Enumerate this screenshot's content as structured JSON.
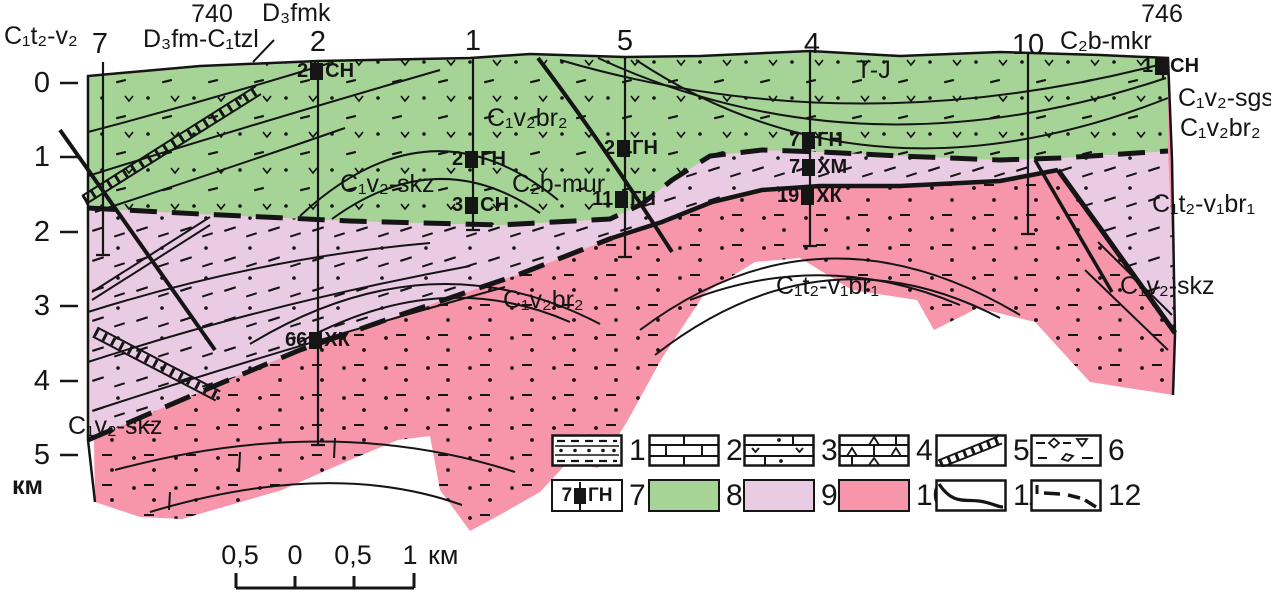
{
  "colors": {
    "green": "#a6d497",
    "lilac": "#eacbe4",
    "pink": "#f796ab",
    "line": "#151515"
  },
  "depth_axis": {
    "ticks": [
      "0",
      "1",
      "2",
      "3",
      "4",
      "5"
    ],
    "unit": "км"
  },
  "top_labels": {
    "left_strat": "C₁t₂-v₂",
    "elev_left": "740",
    "dfm_tzl": "D₃fm-C₁tzl",
    "dfmk": "D₃fmk",
    "elev_right": "746",
    "cb_mkr": "C₂b-mkr"
  },
  "wells": [
    {
      "number": "7"
    },
    {
      "number": "2"
    },
    {
      "number": "1"
    },
    {
      "number": "5"
    },
    {
      "number": "4"
    },
    {
      "number": "10"
    }
  ],
  "zone_labels": {
    "tj": "T-J",
    "green_br2": "C₁v₂br₂",
    "green_skz": "C₁v₂-skz",
    "cb_mur": "C₂b-mur",
    "right_sgs": "C₁v₂-sgs",
    "right_br2": "C₁v₂br₂",
    "right_t2v1br1": "C₁t₂-v₁br₁",
    "right_skz": "C₁v₂-skz",
    "pink_br2": "C₁v₂br₂",
    "pink_t2v1br1": "C₁t₂-v₁br₁",
    "bottom_skz": "C₁v₂-skz"
  },
  "markers": [
    {
      "num": "2",
      "label": "СН"
    },
    {
      "num": "2",
      "label": "ГН"
    },
    {
      "num": "3",
      "label": "СН"
    },
    {
      "num": "2",
      "label": "ГН"
    },
    {
      "num": "11",
      "label": "ГН"
    },
    {
      "num": "7",
      "label": "ГН"
    },
    {
      "num": "7",
      "label": "ХМ"
    },
    {
      "num": "19",
      "label": "ХК"
    },
    {
      "num": "1",
      "label": "СН"
    },
    {
      "num": "66",
      "label": "ХК"
    }
  ],
  "scale_bar": {
    "labels": [
      "0,5",
      "0",
      "0,5",
      "1"
    ],
    "unit": "км"
  },
  "legend": {
    "items": [
      {
        "number": "1",
        "symbol": "dash-dot-bedding-pattern"
      },
      {
        "number": "2",
        "symbol": "limestone-brick-pattern"
      },
      {
        "number": "3",
        "symbol": "dots-and-v-pattern"
      },
      {
        "number": "4",
        "symbol": "triangle-breccia-pattern"
      },
      {
        "number": "5",
        "symbol": "crush-zone-diagonal-band"
      },
      {
        "number": "6",
        "symbol": "diamond-conglomerate-pattern"
      },
      {
        "number": "7",
        "symbol": "well-test-marker",
        "well_num": "7",
        "well_label": "ГН"
      },
      {
        "number": "8",
        "symbol": "green-unit-fill"
      },
      {
        "number": "9",
        "symbol": "lilac-unit-fill"
      },
      {
        "number": "10",
        "symbol": "pink-unit-fill"
      },
      {
        "number": "11",
        "symbol": "geological-boundary-line"
      },
      {
        "number": "12",
        "symbol": "unconformity-dashed-line"
      }
    ]
  }
}
